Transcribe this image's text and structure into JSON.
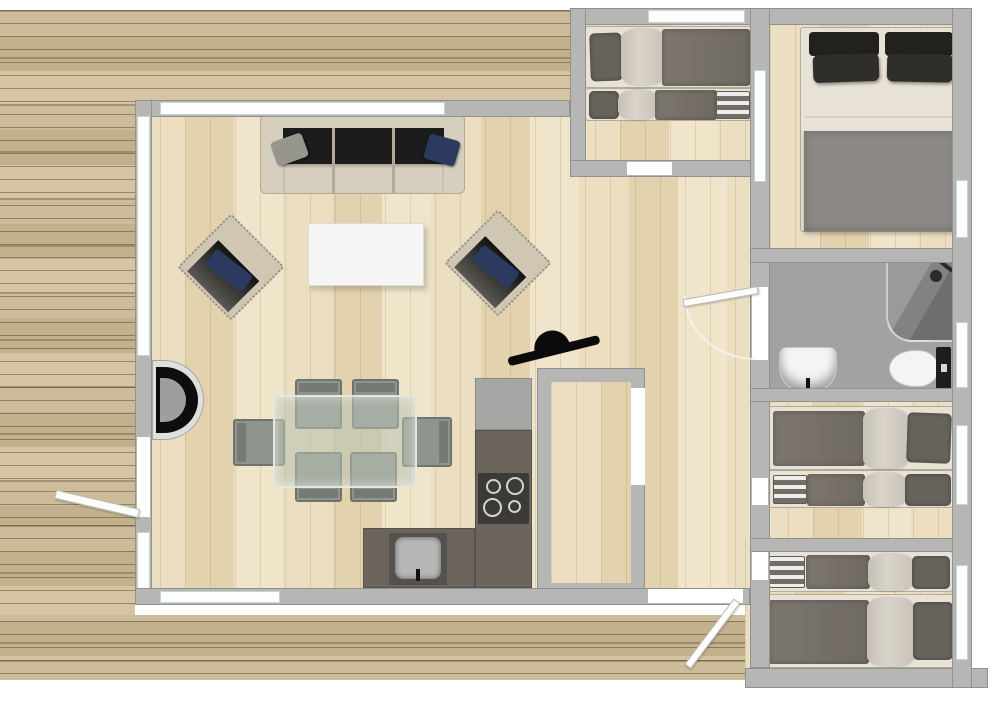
{
  "page": {
    "title": "Holiday lodge floor plan",
    "view": "top-down 2D plan with 3D furniture",
    "has_text_labels": false
  },
  "colors": {
    "deck_a": "#cdbc99",
    "deck_b": "#c2b18c",
    "deck_c": "#d5c5a3",
    "floor_a": "#ecdfc1",
    "floor_b": "#e2d2ad",
    "floor_c": "#f0e5ca",
    "wall": "#b6b6b4",
    "window": "#fcfefe",
    "bathroom_floor": "#a2a2a0",
    "counter": "#6b655e",
    "bed_cream": "#e8e2d6",
    "duvet_dark": "#7b766e",
    "duvet_light": "#d9d4ca",
    "pillow_dark": "#66625c",
    "master_pillow": "#302e2a",
    "blanket_gray": "#8b8885",
    "upholstery": "#d7cfbe",
    "sofa_dark": "#1c1c1c",
    "accent_navy": "#2b3a5e",
    "chair_gray": "#90948e",
    "table_glass": "rgba(184,193,178,0.55)",
    "tv_black": "#0b0b0b",
    "fixture_white": "#f4f4f2",
    "stove_black": "#0d0d0d"
  },
  "rooms": [
    {
      "id": "deck",
      "name": "Deck / terrace",
      "furniture": []
    },
    {
      "id": "living-room",
      "name": "Living room",
      "furniture": [
        "3-seat sofa with grey and navy cushions",
        "white coffee table",
        "armchair with navy cushion",
        "armchair with navy cushion",
        "wood-burning stove on left wall",
        "corner-mounted TV"
      ]
    },
    {
      "id": "dining-area",
      "name": "Dining area",
      "furniture": [
        "glass dining table",
        "6 grey dining chairs"
      ]
    },
    {
      "id": "kitchen",
      "name": "Kitchen",
      "furniture": [
        "L-shaped dark worktop",
        "tall unit",
        "4-ring hob",
        "sink"
      ]
    },
    {
      "id": "hall",
      "name": "Hallway",
      "furniture": [
        "entrance door to deck"
      ]
    },
    {
      "id": "storage",
      "name": "Storage / wardrobe room",
      "furniture": []
    },
    {
      "id": "bunk-bedroom",
      "name": "Twin bedroom (front)",
      "furniture": [
        "single bed",
        "single bed with folded blanket"
      ]
    },
    {
      "id": "master-bedroom",
      "name": "Master bedroom",
      "furniture": [
        "double bed with four dark pillows and grey blanket"
      ]
    },
    {
      "id": "bathroom",
      "name": "Bathroom",
      "furniture": [
        "corner shower",
        "washbasin",
        "toilet"
      ]
    },
    {
      "id": "twin-bedroom",
      "name": "Twin bedroom (middle)",
      "furniture": [
        "single bed",
        "single bed with folded blanket"
      ]
    },
    {
      "id": "rear-bedroom",
      "name": "Twin bedroom (rear)",
      "furniture": [
        "single bed with folded blanket",
        "single bed"
      ]
    }
  ]
}
